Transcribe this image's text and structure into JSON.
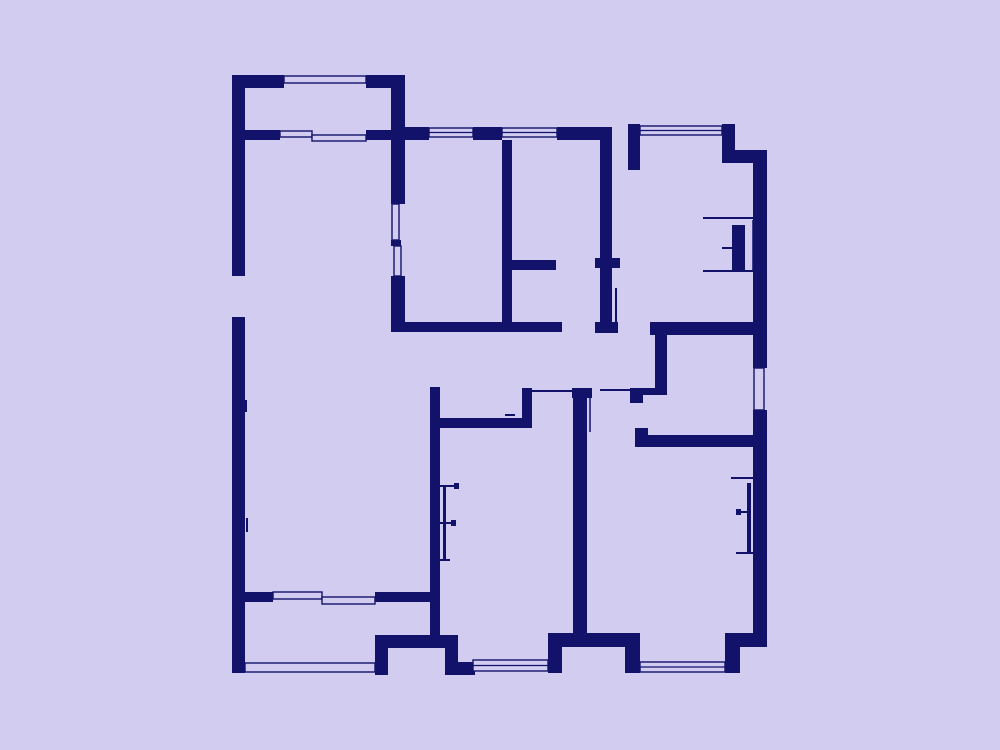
{
  "canvas": {
    "width": 1000,
    "height": 750
  },
  "colors": {
    "background": "#d1ccf0",
    "wall": "#12126b"
  },
  "plan": {
    "walls": [
      [
        232,
        75,
        13,
        201
      ],
      [
        232,
        317,
        13,
        356
      ],
      [
        232,
        75,
        52,
        13
      ],
      [
        366,
        75,
        39,
        13
      ],
      [
        391,
        88,
        14,
        116
      ],
      [
        391,
        240,
        10,
        6
      ],
      [
        391,
        276,
        14,
        56
      ],
      [
        245,
        130,
        35,
        10
      ],
      [
        366,
        130,
        25,
        10
      ],
      [
        405,
        127,
        24,
        13
      ],
      [
        473,
        127,
        29,
        13
      ],
      [
        557,
        127,
        55,
        13
      ],
      [
        628,
        124,
        12,
        46
      ],
      [
        722,
        124,
        13,
        29
      ],
      [
        722,
        150,
        43,
        13
      ],
      [
        753,
        150,
        14,
        218
      ],
      [
        753,
        410,
        14,
        237
      ],
      [
        740,
        633,
        25,
        14
      ],
      [
        725,
        633,
        15,
        40
      ],
      [
        625,
        647,
        15,
        26
      ],
      [
        562,
        633,
        78,
        14
      ],
      [
        548,
        633,
        14,
        40
      ],
      [
        445,
        635,
        13,
        40
      ],
      [
        458,
        662,
        17,
        13
      ],
      [
        375,
        635,
        83,
        13
      ],
      [
        375,
        635,
        13,
        40
      ],
      [
        391,
        322,
        171,
        10
      ],
      [
        502,
        140,
        10,
        182
      ],
      [
        512,
        260,
        44,
        10
      ],
      [
        595,
        258,
        25,
        10
      ],
      [
        600,
        140,
        12,
        192
      ],
      [
        595,
        322,
        23,
        11
      ],
      [
        650,
        322,
        115,
        13
      ],
      [
        655,
        322,
        12,
        73
      ],
      [
        630,
        388,
        37,
        7
      ],
      [
        630,
        388,
        13,
        15
      ],
      [
        430,
        387,
        10,
        250
      ],
      [
        435,
        418,
        95,
        10
      ],
      [
        522,
        388,
        10,
        40
      ],
      [
        572,
        388,
        20,
        10
      ],
      [
        573,
        398,
        14,
        237
      ],
      [
        635,
        435,
        130,
        12
      ],
      [
        635,
        428,
        13,
        7
      ],
      [
        243,
        592,
        30,
        10
      ],
      [
        375,
        592,
        65,
        10
      ]
    ],
    "windows": [
      {
        "x": 284,
        "y": 76,
        "w": 82,
        "h": 7,
        "n": 2
      },
      {
        "x": 280,
        "y": 131,
        "w": 32,
        "h": 6,
        "n": 2
      },
      {
        "x": 312,
        "y": 135,
        "w": 54,
        "h": 6,
        "n": 2
      },
      {
        "x": 429,
        "y": 128,
        "w": 44,
        "h": 9,
        "n": 3
      },
      {
        "x": 502,
        "y": 128,
        "w": 55,
        "h": 9,
        "n": 3
      },
      {
        "x": 640,
        "y": 126,
        "w": 82,
        "h": 9,
        "n": 3
      },
      {
        "x": 754,
        "y": 368,
        "w": 10,
        "h": 42,
        "n": 2
      },
      {
        "x": 640,
        "y": 662,
        "w": 85,
        "h": 10,
        "n": 3
      },
      {
        "x": 473,
        "y": 660,
        "w": 75,
        "h": 11,
        "n": 3
      },
      {
        "x": 245,
        "y": 663,
        "w": 130,
        "h": 9,
        "n": 2
      },
      {
        "x": 392,
        "y": 204,
        "w": 7,
        "h": 36,
        "n": 2
      },
      {
        "x": 394,
        "y": 246,
        "w": 7,
        "h": 30,
        "n": 2
      },
      {
        "x": 273,
        "y": 592,
        "w": 49,
        "h": 7,
        "n": 2
      },
      {
        "x": 322,
        "y": 597,
        "w": 53,
        "h": 7,
        "n": 2
      }
    ],
    "leaves": [
      [
        732,
        225,
        13,
        45
      ],
      [
        443,
        485,
        3,
        75
      ],
      [
        747,
        483,
        4,
        70
      ]
    ],
    "lines": [
      [
        532,
        391,
        572,
        391,
        2
      ],
      [
        600,
        390,
        630,
        390,
        2
      ],
      [
        616,
        288,
        616,
        330,
        2
      ],
      [
        574,
        398,
        574,
        432,
        1.5
      ],
      [
        590,
        398,
        590,
        432,
        1.5
      ],
      [
        703,
        218,
        753,
        218,
        2
      ],
      [
        703,
        271,
        753,
        271,
        2
      ],
      [
        722,
        248,
        732,
        248,
        2
      ],
      [
        753,
        220,
        753,
        270,
        1.5
      ],
      [
        440,
        486,
        459,
        486,
        2
      ],
      [
        454,
        486,
        459,
        486,
        6
      ],
      [
        440,
        523,
        456,
        523,
        2
      ],
      [
        451,
        523,
        456,
        523,
        6
      ],
      [
        440,
        560,
        450,
        560,
        2
      ],
      [
        731,
        478,
        753,
        478,
        2
      ],
      [
        736,
        512,
        747,
        512,
        2
      ],
      [
        736,
        512,
        741,
        512,
        6
      ],
      [
        736,
        553,
        753,
        553,
        2
      ],
      [
        753,
        456,
        759,
        456,
        2
      ],
      [
        753,
        464,
        759,
        464,
        2
      ],
      [
        753,
        472,
        759,
        472,
        2
      ],
      [
        505,
        415,
        515,
        415,
        2
      ],
      [
        247,
        518,
        247,
        532,
        2
      ],
      [
        246,
        400,
        246,
        412,
        2
      ]
    ]
  }
}
